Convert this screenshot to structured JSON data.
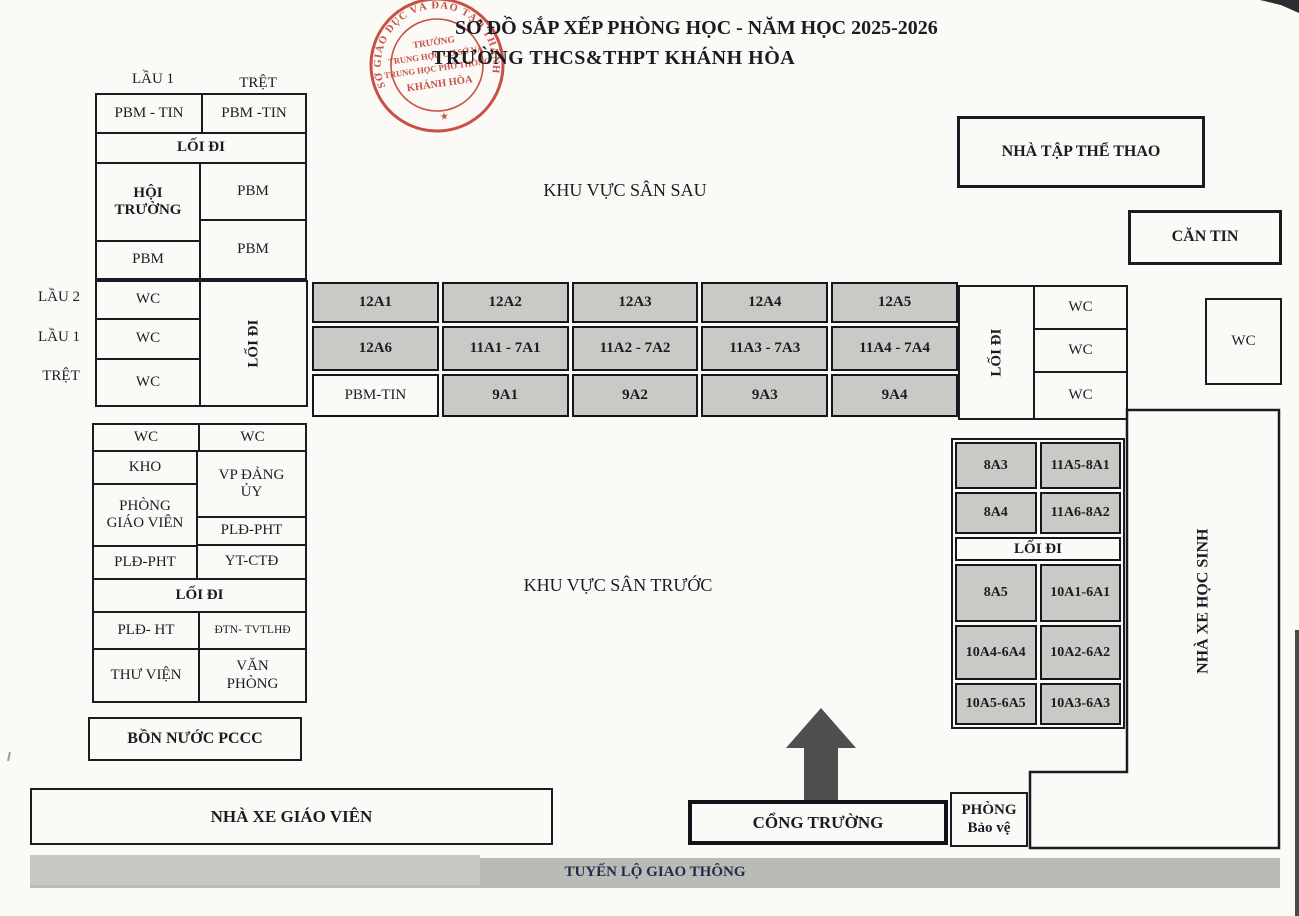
{
  "page": {
    "bg": "#fbfaf6",
    "ink": "#1b1b24",
    "cell_gray": "#cac9c5",
    "stamp_red": "#c13a2e",
    "road_gray": "#b8bbb6",
    "arrow_gray": "#4f4f4f",
    "road_text_color": "#232c49"
  },
  "header": {
    "title_line1": "SƠ ĐỒ SẮP XẾP PHÒNG HỌC - NĂM HỌC 2025-2026",
    "title_line2": "TRƯỜNG THCS&THPT KHÁNH HÒA"
  },
  "stamp": {
    "ring": "SỞ GIÁO DỤC VÀ ĐÀO TẠO THÀNH PHỐ CẦN THƠ",
    "star": "★",
    "center_lines": [
      "TRƯỜNG",
      "TRUNG HỌC CƠ SỞ VÀ",
      "TRUNG HỌC PHỔ THÔNG",
      "KHÁNH HÒA"
    ]
  },
  "labels": {
    "floor_upper": [
      "LẦU 1",
      "TRỆT"
    ],
    "floors": [
      "LẦU 2",
      "LẦU 1",
      "TRỆT"
    ]
  },
  "hall_block": {
    "r1c1": "PBM - TIN",
    "r1c2": "PBM -TIN",
    "walkway": "LỐI ĐI",
    "left": [
      "HỘI TRƯỜNG",
      "PBM"
    ],
    "right": [
      "PBM",
      "PBM"
    ]
  },
  "wc_block": {
    "cells": [
      "WC",
      "WC",
      "WC"
    ],
    "walkway": "LỐI ĐI"
  },
  "class_grid": {
    "rows": [
      [
        "12A1",
        "12A2",
        "12A3",
        "12A4",
        "12A5"
      ],
      [
        "12A6",
        "11A1 - 7A1",
        "11A2 - 7A2",
        "11A3 - 7A3",
        "11A4 - 7A4"
      ],
      [
        "PBM-TIN",
        "9A1",
        "9A2",
        "9A3",
        "9A4"
      ]
    ]
  },
  "right_wc_block": {
    "walkway": "LỐI ĐI",
    "cells": [
      "WC",
      "WC",
      "WC"
    ]
  },
  "wc_standalone": "WC",
  "gym": "NHÀ TẬP THỂ THAO",
  "canteen": "CĂN TIN",
  "yards": {
    "back": "KHU VỰC SÂN SAU",
    "front": "KHU VỰC SÂN TRƯỚC"
  },
  "admin_block": {
    "wc_row": [
      "WC",
      "WC"
    ],
    "left": [
      "KHO",
      "PHÒNG GIÁO VIÊN",
      "PLĐ-PHT"
    ],
    "right": [
      "VP ĐẢNG ỦY",
      "PLĐ-PHT",
      "YT-CTĐ"
    ],
    "walkway": "LỐI ĐI",
    "row5": [
      "PLĐ- HT",
      "ĐTN- TVTLHĐ"
    ],
    "row6": [
      "THƯ VIỆN",
      "VĂN PHÒNG"
    ]
  },
  "water_tank": "BỒN NƯỚC PCCC",
  "east_block": {
    "rows_top": [
      [
        "8A3",
        "11A5-8A1"
      ],
      [
        "8A4",
        "11A6-8A2"
      ]
    ],
    "walkway": "LỐI ĐI",
    "rows_bottom": [
      [
        "8A5",
        "10A1-6A1"
      ],
      [
        "10A4-6A4",
        "10A2-6A2"
      ],
      [
        "10A5-6A5",
        "10A3-6A3"
      ]
    ]
  },
  "student_parking": "NHÀ XE HỌC SINH",
  "teacher_parking": "NHÀ XE GIÁO VIÊN",
  "gate": "CỔNG TRƯỜNG",
  "guard": {
    "line1": "PHÒNG",
    "line2": "Bảo vệ"
  },
  "road": "TUYẾN LỘ GIAO THÔNG"
}
